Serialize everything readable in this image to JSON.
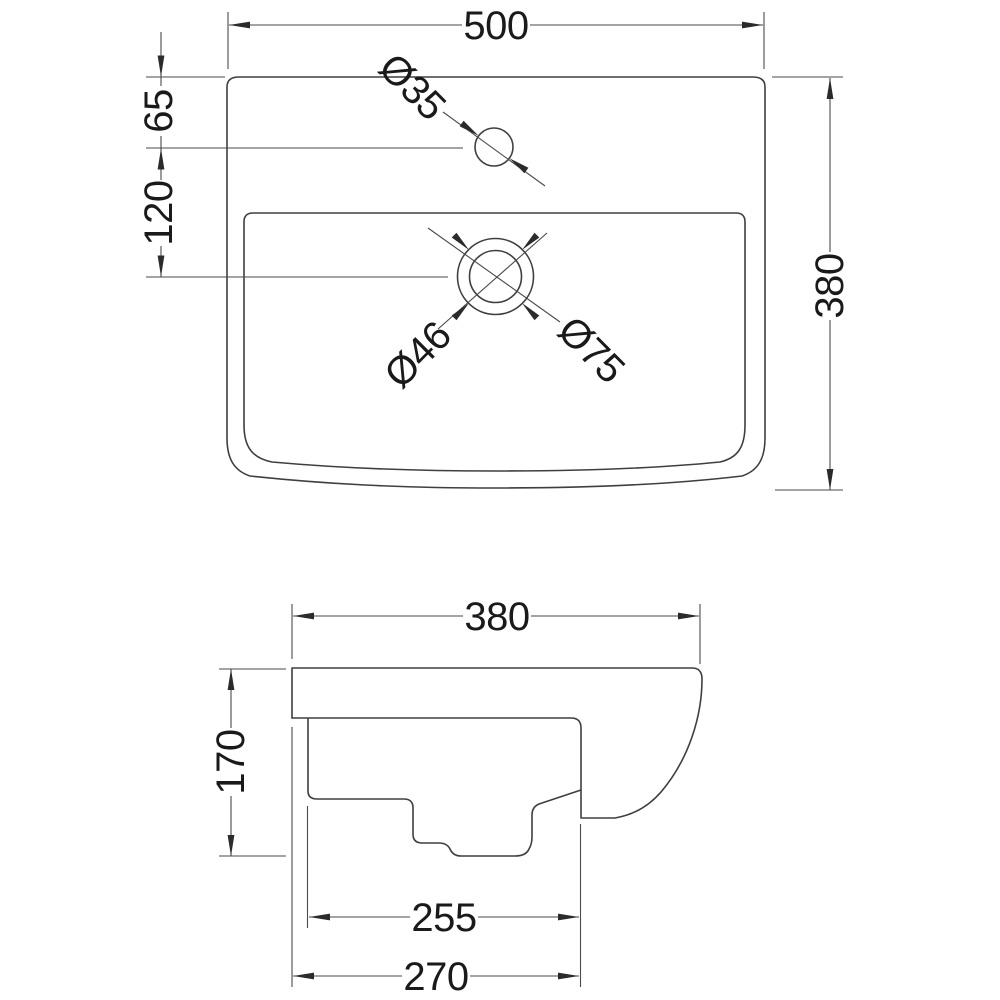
{
  "drawing": {
    "description": "Basin technical drawing with plan view and side profile view",
    "top_view": {
      "width_mm": "500",
      "depth_mm": "380",
      "tap_hole_offset_mm": "65",
      "tap_to_waste_mm": "120",
      "tap_hole_diameter": "Ø35",
      "waste_inner_diameter": "Ø46",
      "waste_outer_diameter": "Ø75"
    },
    "side_view": {
      "depth_mm": "380",
      "height_mm": "170",
      "recess_depth_mm": "255",
      "overall_depth_mm": "270"
    },
    "colors": {
      "background": "#ffffff",
      "geometry_line": "#3f3f3f",
      "dimension_line": "#4a4a4a",
      "text": "#1a1a1a",
      "arrow": "#2b2b2b"
    }
  }
}
